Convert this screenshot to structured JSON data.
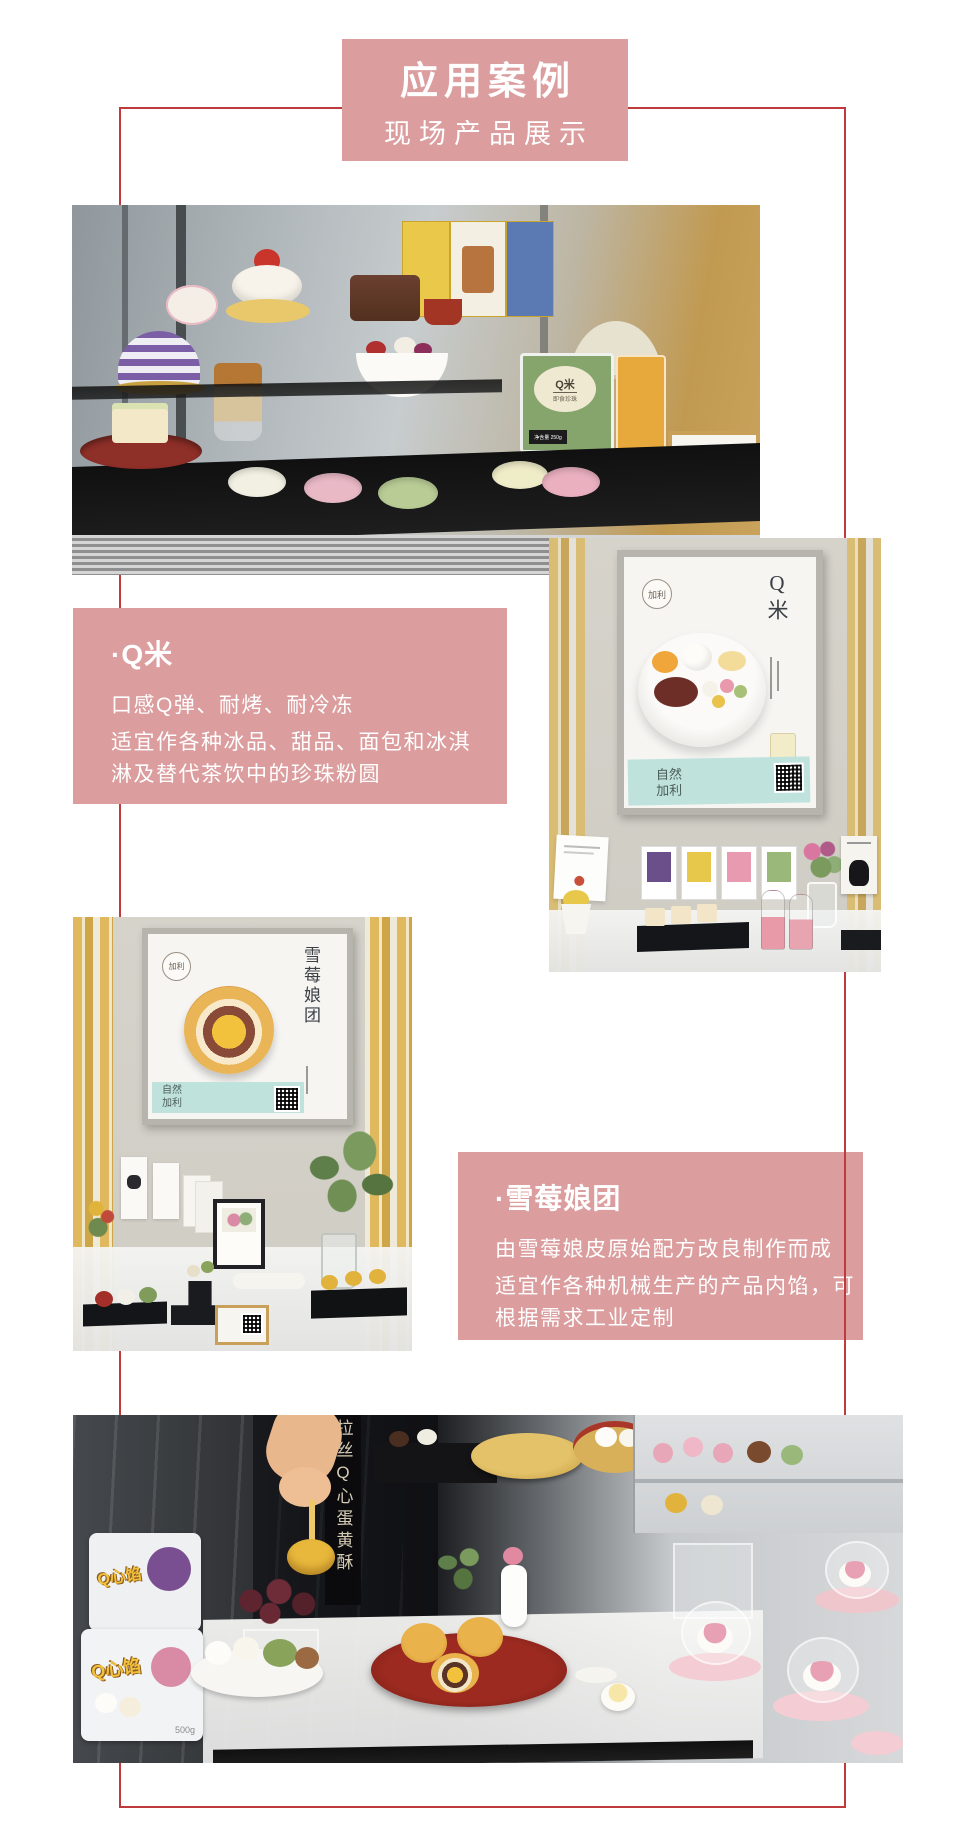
{
  "header": {
    "title": "应用案例",
    "subtitle": "现场产品展示"
  },
  "blocks": {
    "qmi": {
      "title": "·Q米",
      "line1": "口感Q弹、耐烤、耐冷冻",
      "para2": "适宜作各种冰品、甜品、面包和冰淇淋及替代茶饮中的珍珠粉圆"
    },
    "xuemei": {
      "title": "·雪莓娘团",
      "line1": "由雪莓娘皮原始配方改良制作而成",
      "para2": "适宜作各种机械生产的产品内馅，可根据需求工业定制"
    }
  },
  "photos": {
    "display_case": {
      "package_label": "Q米",
      "package_sublabel": "即食珍珠",
      "package_weight": "净含量 250g",
      "wood_sign": "加利Q米"
    },
    "qmi_poster": {
      "brand": "加利",
      "title": "Q米",
      "band": "自然加利"
    },
    "xuemei_poster": {
      "brand": "加利",
      "title": "雪莓娘团",
      "band": "自然加利"
    },
    "bottom_display": {
      "vertical_sign": "拉丝Q心蛋黄酥",
      "package1_text": "Q心馅",
      "package2_text": "Q心馅",
      "package2_weight": "500g"
    }
  },
  "colors": {
    "accent_pink": "#db9d9e",
    "frame_red": "#bf3a3c",
    "teal_band": "#bfe2dc",
    "slat_gold": "#d9bd74"
  }
}
